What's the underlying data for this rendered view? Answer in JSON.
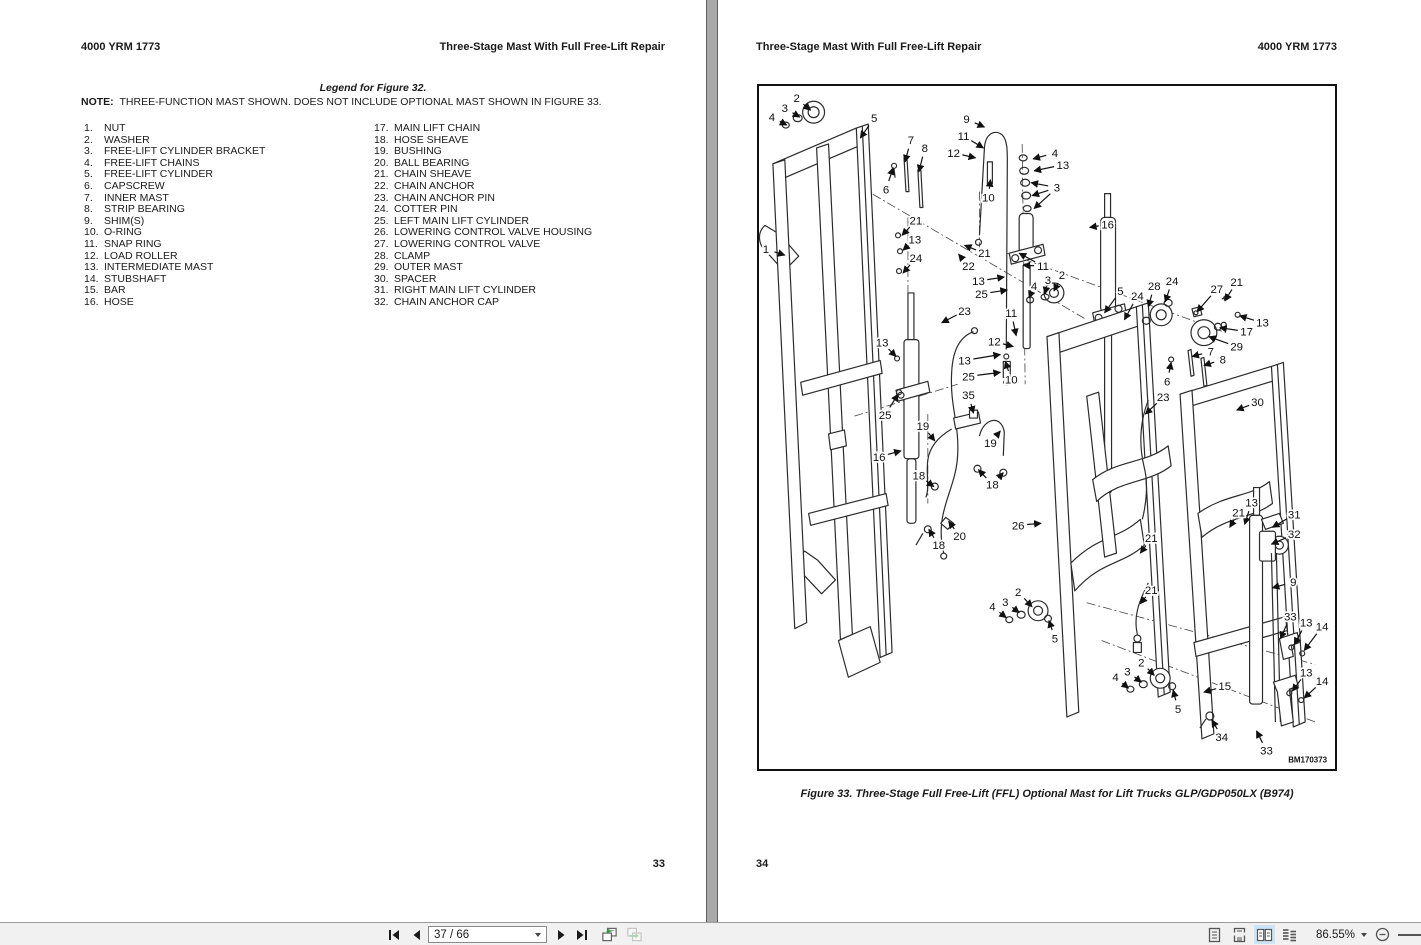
{
  "left_page": {
    "header_left": "4000 YRM 1773",
    "header_right": "Three-Stage Mast With Full Free-Lift Repair",
    "legend_title": "Legend for Figure 32.",
    "note_label": "NOTE:",
    "note_text": "THREE-FUNCTION MAST SHOWN. DOES NOT INCLUDE OPTIONAL MAST SHOWN IN FIGURE 33.",
    "legend": {
      "col1": [
        {
          "n": "1.",
          "t": "NUT"
        },
        {
          "n": "2.",
          "t": "WASHER"
        },
        {
          "n": "3.",
          "t": "FREE-LIFT CYLINDER BRACKET"
        },
        {
          "n": "4.",
          "t": "FREE-LIFT CHAINS"
        },
        {
          "n": "5.",
          "t": "FREE-LIFT CYLINDER"
        },
        {
          "n": "6.",
          "t": "CAPSCREW"
        },
        {
          "n": "7.",
          "t": "INNER MAST"
        },
        {
          "n": "8.",
          "t": "STRIP BEARING"
        },
        {
          "n": "9.",
          "t": "SHIM(S)"
        },
        {
          "n": "10.",
          "t": "O-RING"
        },
        {
          "n": "11.",
          "t": "SNAP RING"
        },
        {
          "n": "12.",
          "t": "LOAD ROLLER"
        },
        {
          "n": "13.",
          "t": "INTERMEDIATE MAST"
        },
        {
          "n": "14.",
          "t": "STUBSHAFT"
        },
        {
          "n": "15.",
          "t": "BAR"
        },
        {
          "n": "16.",
          "t": "HOSE"
        }
      ],
      "col2": [
        {
          "n": "17.",
          "t": "MAIN LIFT CHAIN"
        },
        {
          "n": "18.",
          "t": "HOSE SHEAVE"
        },
        {
          "n": "19.",
          "t": "BUSHING"
        },
        {
          "n": "20.",
          "t": "BALL BEARING"
        },
        {
          "n": "21.",
          "t": "CHAIN SHEAVE"
        },
        {
          "n": "22.",
          "t": "CHAIN ANCHOR"
        },
        {
          "n": "23.",
          "t": "CHAIN ANCHOR PIN"
        },
        {
          "n": "24.",
          "t": "COTTER PIN"
        },
        {
          "n": "25.",
          "t": "LEFT MAIN LIFT CYLINDER"
        },
        {
          "n": "26.",
          "t": "LOWERING CONTROL VALVE HOUSING"
        },
        {
          "n": "27.",
          "t": "LOWERING CONTROL VALVE"
        },
        {
          "n": "28.",
          "t": "CLAMP"
        },
        {
          "n": "29.",
          "t": "OUTER MAST"
        },
        {
          "n": "30.",
          "t": "SPACER"
        },
        {
          "n": "31.",
          "t": "RIGHT MAIN LIFT CYLINDER"
        },
        {
          "n": "32.",
          "t": "CHAIN ANCHOR CAP"
        }
      ]
    },
    "page_number": "33"
  },
  "right_page": {
    "header_left": "Three-Stage Mast With Full Free-Lift Repair",
    "header_right": "4000 YRM 1773",
    "figure": {
      "caption": "Figure 33. Three-Stage Full Free-Lift (FFL) Optional Mast for Lift Trucks GLP/GDP050LX (B974)",
      "watermark": "BM170373",
      "callouts": [
        {
          "n": "2",
          "x": 38,
          "y": 12,
          "ax": 52,
          "ay": 24
        },
        {
          "n": "3",
          "x": 26,
          "y": 22,
          "ax": 41,
          "ay": 31
        },
        {
          "n": "4",
          "x": 13,
          "y": 31,
          "ax": 28,
          "ay": 39
        },
        {
          "n": "5",
          "x": 116,
          "y": 32,
          "ax": 102,
          "ay": 52
        },
        {
          "n": "7",
          "x": 153,
          "y": 54,
          "ax": 147,
          "ay": 76
        },
        {
          "n": "8",
          "x": 167,
          "y": 62,
          "ax": 161,
          "ay": 86
        },
        {
          "n": "6",
          "x": 128,
          "y": 104,
          "ax": 135,
          "ay": 82
        },
        {
          "n": "9",
          "x": 209,
          "y": 33,
          "ax": 227,
          "ay": 41
        },
        {
          "n": "11",
          "x": 206,
          "y": 50,
          "ax": 226,
          "ay": 62
        },
        {
          "n": "12",
          "x": 196,
          "y": 67,
          "ax": 218,
          "ay": 72
        },
        {
          "n": "10",
          "x": 231,
          "y": 112,
          "ax": 233,
          "ay": 94
        },
        {
          "n": "4",
          "x": 298,
          "y": 67,
          "ax": 276,
          "ay": 73
        },
        {
          "n": "13",
          "x": 306,
          "y": 79,
          "ax": 277,
          "ay": 85
        },
        {
          "n": "3",
          "x": 300,
          "y": 102,
          "ax": 274,
          "ay": 97
        },
        {
          "n": "",
          "x": 300,
          "y": 102,
          "ax": 275,
          "ay": 110
        },
        {
          "n": "",
          "x": 300,
          "y": 102,
          "ax": 277,
          "ay": 123
        },
        {
          "n": "16",
          "x": 351,
          "y": 139,
          "ax": 333,
          "ay": 142
        },
        {
          "n": "1",
          "x": 7,
          "y": 164,
          "ax": 26,
          "ay": 170
        },
        {
          "n": "21",
          "x": 158,
          "y": 135,
          "ax": 144,
          "ay": 150
        },
        {
          "n": "13",
          "x": 157,
          "y": 154,
          "ax": 145,
          "ay": 165
        },
        {
          "n": "24",
          "x": 158,
          "y": 173,
          "ax": 145,
          "ay": 188
        },
        {
          "n": "21",
          "x": 227,
          "y": 168,
          "ax": 207,
          "ay": 160
        },
        {
          "n": "22",
          "x": 211,
          "y": 181,
          "ax": 201,
          "ay": 169
        },
        {
          "n": "13",
          "x": 221,
          "y": 196,
          "ax": 247,
          "ay": 192
        },
        {
          "n": "25",
          "x": 224,
          "y": 209,
          "ax": 250,
          "ay": 205
        },
        {
          "n": "23",
          "x": 207,
          "y": 226,
          "ax": 184,
          "ay": 238
        },
        {
          "n": "11",
          "x": 254,
          "y": 228,
          "ax": 259,
          "ay": 251
        },
        {
          "n": "11",
          "x": 286,
          "y": 181,
          "ax": 262,
          "ay": 168
        },
        {
          "n": "",
          "x": 286,
          "y": 181,
          "ax": 266,
          "ay": 180
        },
        {
          "n": "2",
          "x": 305,
          "y": 190,
          "ax": 297,
          "ay": 206
        },
        {
          "n": "3",
          "x": 291,
          "y": 195,
          "ax": 288,
          "ay": 209
        },
        {
          "n": "4",
          "x": 277,
          "y": 201,
          "ax": 272,
          "ay": 213
        },
        {
          "n": "12",
          "x": 237,
          "y": 257,
          "ax": 256,
          "ay": 262
        },
        {
          "n": "13",
          "x": 207,
          "y": 276,
          "ax": 243,
          "ay": 270
        },
        {
          "n": "25",
          "x": 211,
          "y": 292,
          "ax": 243,
          "ay": 288
        },
        {
          "n": "10",
          "x": 254,
          "y": 295,
          "ax": 248,
          "ay": 277
        },
        {
          "n": "13",
          "x": 124,
          "y": 258,
          "ax": 138,
          "ay": 272
        },
        {
          "n": "25",
          "x": 127,
          "y": 331,
          "ax": 140,
          "ay": 310
        },
        {
          "n": "35",
          "x": 211,
          "y": 311,
          "ax": 216,
          "ay": 329
        },
        {
          "n": "5",
          "x": 364,
          "y": 206,
          "ax": 348,
          "ay": 228
        },
        {
          "n": "24",
          "x": 381,
          "y": 211,
          "ax": 368,
          "ay": 235
        },
        {
          "n": "28",
          "x": 398,
          "y": 201,
          "ax": 392,
          "ay": 222
        },
        {
          "n": "24",
          "x": 416,
          "y": 196,
          "ax": 409,
          "ay": 217
        },
        {
          "n": "27",
          "x": 461,
          "y": 204,
          "ax": 441,
          "ay": 227
        },
        {
          "n": "21",
          "x": 481,
          "y": 197,
          "ax": 469,
          "ay": 216
        },
        {
          "n": "13",
          "x": 507,
          "y": 238,
          "ax": 484,
          "ay": 231
        },
        {
          "n": "17",
          "x": 491,
          "y": 247,
          "ax": 464,
          "ay": 243
        },
        {
          "n": "29",
          "x": 481,
          "y": 262,
          "ax": 453,
          "ay": 252
        },
        {
          "n": "7",
          "x": 455,
          "y": 267,
          "ax": 436,
          "ay": 272
        },
        {
          "n": "8",
          "x": 467,
          "y": 275,
          "ax": 448,
          "ay": 281
        },
        {
          "n": "6",
          "x": 411,
          "y": 297,
          "ax": 415,
          "ay": 278
        },
        {
          "n": "23",
          "x": 407,
          "y": 313,
          "ax": 389,
          "ay": 330
        },
        {
          "n": "30",
          "x": 502,
          "y": 318,
          "ax": 481,
          "ay": 326
        },
        {
          "n": "16",
          "x": 121,
          "y": 373,
          "ax": 143,
          "ay": 367
        },
        {
          "n": "19",
          "x": 165,
          "y": 342,
          "ax": 177,
          "ay": 357
        },
        {
          "n": "19",
          "x": 233,
          "y": 359,
          "ax": 243,
          "ay": 347
        },
        {
          "n": "18",
          "x": 161,
          "y": 392,
          "ax": 176,
          "ay": 403
        },
        {
          "n": "18",
          "x": 235,
          "y": 401,
          "ax": 221,
          "ay": 386
        },
        {
          "n": "",
          "x": 235,
          "y": 401,
          "ax": 246,
          "ay": 389
        },
        {
          "n": "20",
          "x": 202,
          "y": 453,
          "ax": 191,
          "ay": 438
        },
        {
          "n": "18",
          "x": 181,
          "y": 462,
          "ax": 171,
          "ay": 446
        },
        {
          "n": "26",
          "x": 261,
          "y": 442,
          "ax": 284,
          "ay": 440
        },
        {
          "n": "2",
          "x": 261,
          "y": 509,
          "ax": 275,
          "ay": 524
        },
        {
          "n": "3",
          "x": 248,
          "y": 519,
          "ax": 262,
          "ay": 530
        },
        {
          "n": "4",
          "x": 235,
          "y": 524,
          "ax": 249,
          "ay": 535
        },
        {
          "n": "5",
          "x": 298,
          "y": 556,
          "ax": 292,
          "ay": 538
        },
        {
          "n": "21",
          "x": 395,
          "y": 455,
          "ax": 384,
          "ay": 470
        },
        {
          "n": "21",
          "x": 395,
          "y": 507,
          "ax": 384,
          "ay": 521
        },
        {
          "n": "13",
          "x": 496,
          "y": 419,
          "ax": 489,
          "ay": 441
        },
        {
          "n": "21",
          "x": 483,
          "y": 429,
          "ax": 474,
          "ay": 444
        },
        {
          "n": "31",
          "x": 539,
          "y": 431,
          "ax": 517,
          "ay": 444
        },
        {
          "n": "32",
          "x": 539,
          "y": 451,
          "ax": 516,
          "ay": 461
        },
        {
          "n": "9",
          "x": 538,
          "y": 499,
          "ax": 517,
          "ay": 505
        },
        {
          "n": "33",
          "x": 535,
          "y": 534,
          "ax": 525,
          "ay": 556
        },
        {
          "n": "13",
          "x": 551,
          "y": 540,
          "ax": 539,
          "ay": 562
        },
        {
          "n": "14",
          "x": 567,
          "y": 544,
          "ax": 549,
          "ay": 568
        },
        {
          "n": "13",
          "x": 551,
          "y": 590,
          "ax": 537,
          "ay": 609
        },
        {
          "n": "14",
          "x": 567,
          "y": 599,
          "ax": 549,
          "ay": 616
        },
        {
          "n": "2",
          "x": 385,
          "y": 580,
          "ax": 398,
          "ay": 593
        },
        {
          "n": "3",
          "x": 371,
          "y": 589,
          "ax": 385,
          "ay": 600
        },
        {
          "n": "4",
          "x": 359,
          "y": 595,
          "ax": 372,
          "ay": 606
        },
        {
          "n": "5",
          "x": 422,
          "y": 627,
          "ax": 417,
          "ay": 608
        },
        {
          "n": "15",
          "x": 469,
          "y": 604,
          "ax": 448,
          "ay": 610
        },
        {
          "n": "34",
          "x": 466,
          "y": 655,
          "ax": 456,
          "ay": 638
        },
        {
          "n": "33",
          "x": 511,
          "y": 669,
          "ax": 501,
          "ay": 649
        }
      ]
    },
    "page_number": "34"
  },
  "toolbar": {
    "page_value": "37 / 66",
    "zoom_value": "86.55%",
    "icons": [
      "first-page",
      "previous-page",
      "next-page",
      "last-page",
      "previous-view",
      "next-view",
      "single-page-view",
      "continuous-view",
      "two-page-view",
      "two-page-continuous-view",
      "zoom-out"
    ],
    "selected_view": "two-page-view",
    "selected_view_color": "#cde4f6"
  }
}
